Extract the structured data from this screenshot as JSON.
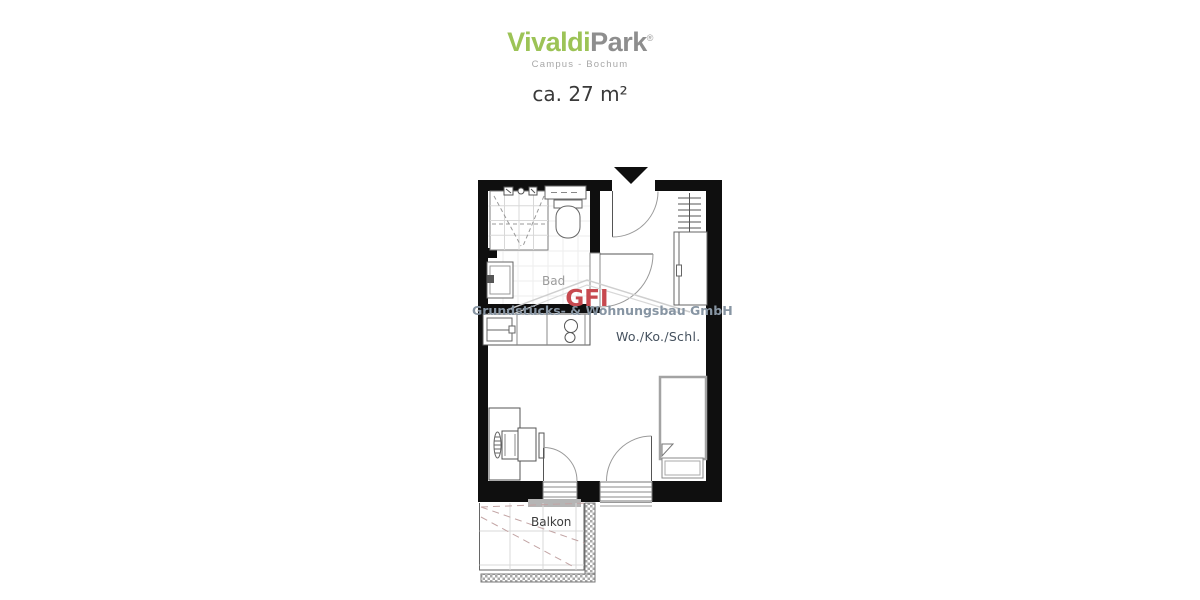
{
  "header": {
    "brand_green": "Vivaldi",
    "brand_gray": "Park",
    "registered_mark": "®",
    "subtitle": "Campus - Bochum",
    "area": "ca. 27 m²"
  },
  "rooms": {
    "bathroom": "Bad",
    "living": "Wo./Ko./Schl.",
    "balcony": "Balkon"
  },
  "watermark": {
    "abbr": "GFI",
    "company": "Grundstücks- & Wohnungsbau GmbH"
  },
  "colors": {
    "brand_green": "#9cc356",
    "brand_gray": "#8e8e8e",
    "watermark_red": "#c7494f",
    "watermark_gray_blue": "#8795a3",
    "wall_black": "#0f0f0f"
  },
  "fixtures": [
    "shower",
    "toilet",
    "shelf",
    "washbasin",
    "kitchen-counter",
    "kitchen-sink",
    "cooktop",
    "wardrobe",
    "coat-rack",
    "desk",
    "chair",
    "bed",
    "balcony-doors",
    "balcony-railing",
    "entrance-marker"
  ]
}
